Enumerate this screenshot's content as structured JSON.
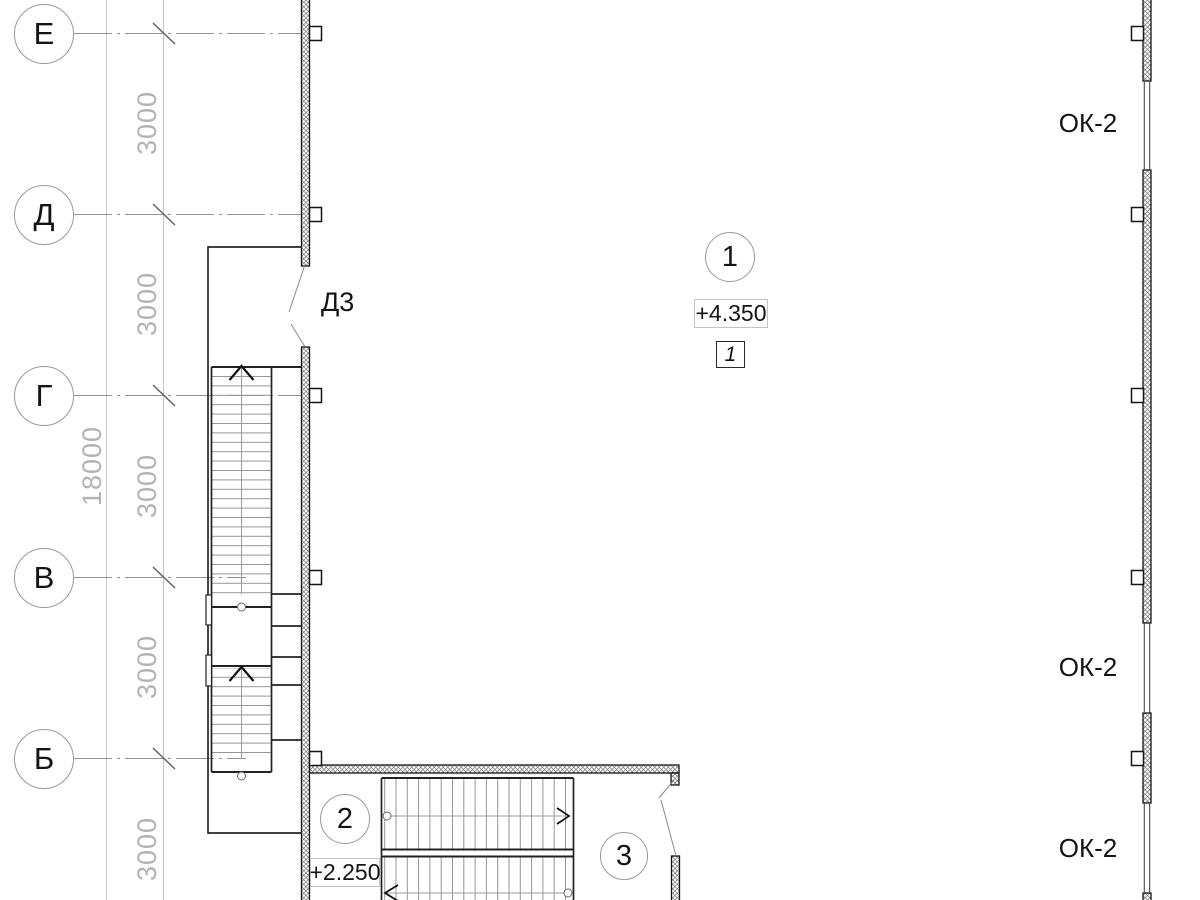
{
  "axes": {
    "bubbles": [
      {
        "label": "Е"
      },
      {
        "label": "Д"
      },
      {
        "label": "Г"
      },
      {
        "label": "В"
      },
      {
        "label": "Б"
      }
    ],
    "overall_dim": "18000",
    "bay_dims": [
      "3000",
      "3000",
      "3000",
      "3000",
      "3000"
    ]
  },
  "marks": {
    "door": "Д3",
    "windows": [
      "ОК-2",
      "ОК-2",
      "ОК-2"
    ],
    "bubble_1": "1",
    "bubble_2": "2",
    "bubble_3": "3",
    "elevation_upper": "+4.350",
    "elevation_lower": "+2.250",
    "section_flag": "1"
  },
  "colors": {
    "ink": "#151515",
    "dark_line": "#222222",
    "grid_gray": "#929292",
    "dim_gray": "#c6c6c6",
    "tread_gray": "#969696"
  }
}
